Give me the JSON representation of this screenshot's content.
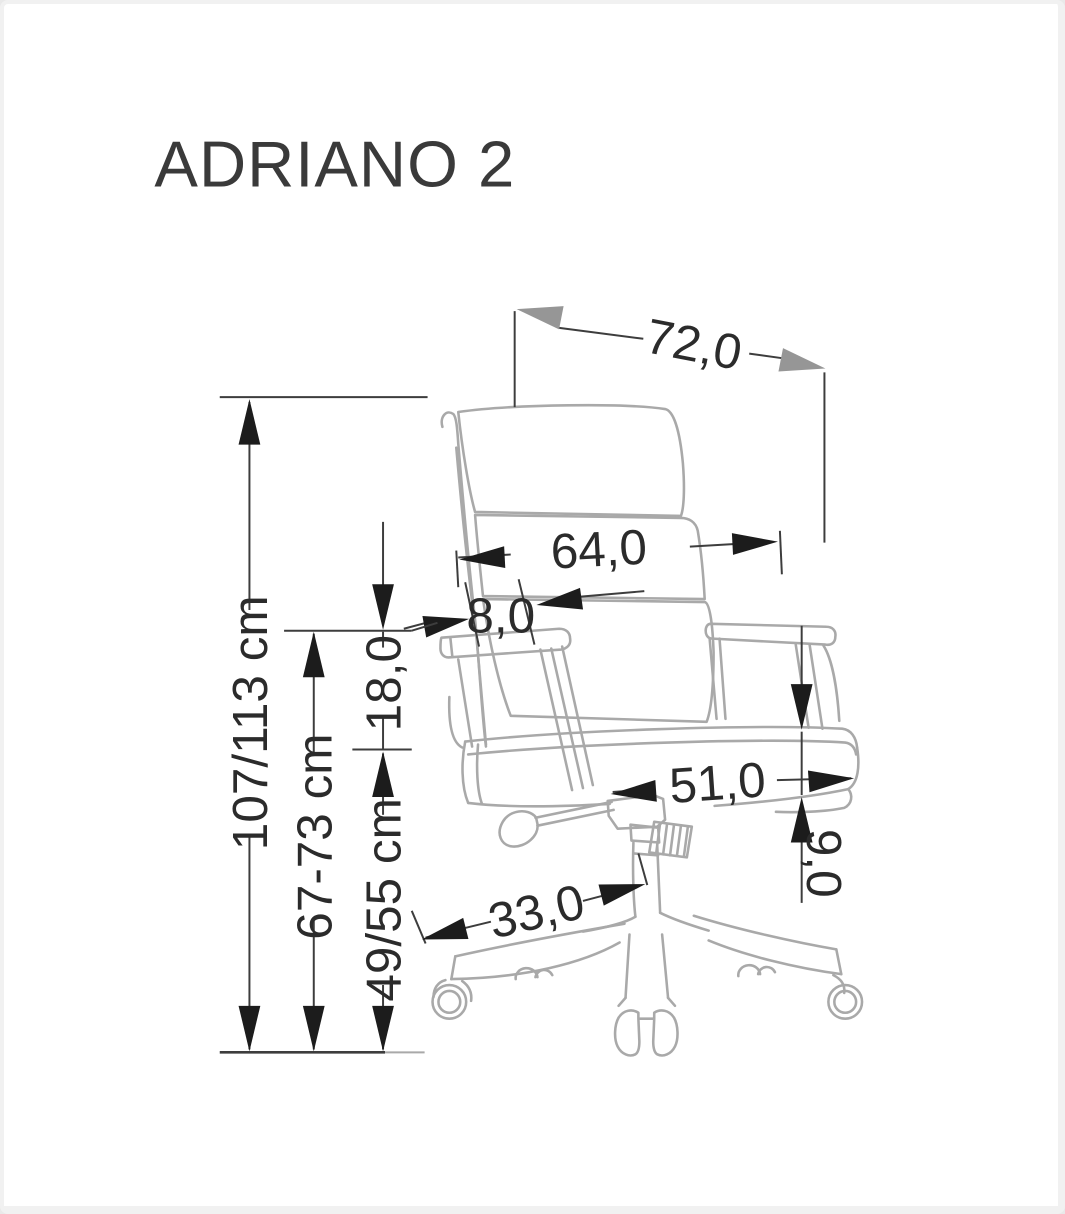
{
  "title": "ADRIANO 2",
  "drawing": {
    "subject": "office-chair-side-profile-technical-drawing",
    "units_style": "centimeters, comma decimals"
  },
  "colors": {
    "background": "#ffffff",
    "frame_border": "#f1f1f1",
    "chair_line": "#a9a9a9",
    "dimension_line": "#3d3d3d",
    "dimension_text": "#2b2b2b",
    "arrow_black": "#1c1c1c",
    "arrow_gray": "#969696"
  },
  "dimensions": {
    "overall_depth": {
      "value": "72,0"
    },
    "backrest_width": {
      "value": "64,0"
    },
    "backrest_thickness": {
      "value": "8,0"
    },
    "armrest_above_seat": {
      "value": "18,0"
    },
    "total_height": {
      "value": "107/113 cm"
    },
    "armrest_height": {
      "value": "67-73 cm"
    },
    "seat_height": {
      "value": "49/55 cm"
    },
    "seat_depth": {
      "value": "51,0"
    },
    "seat_thickness": {
      "value": "9,0"
    },
    "base_leg_length": {
      "value": "33,0"
    }
  }
}
